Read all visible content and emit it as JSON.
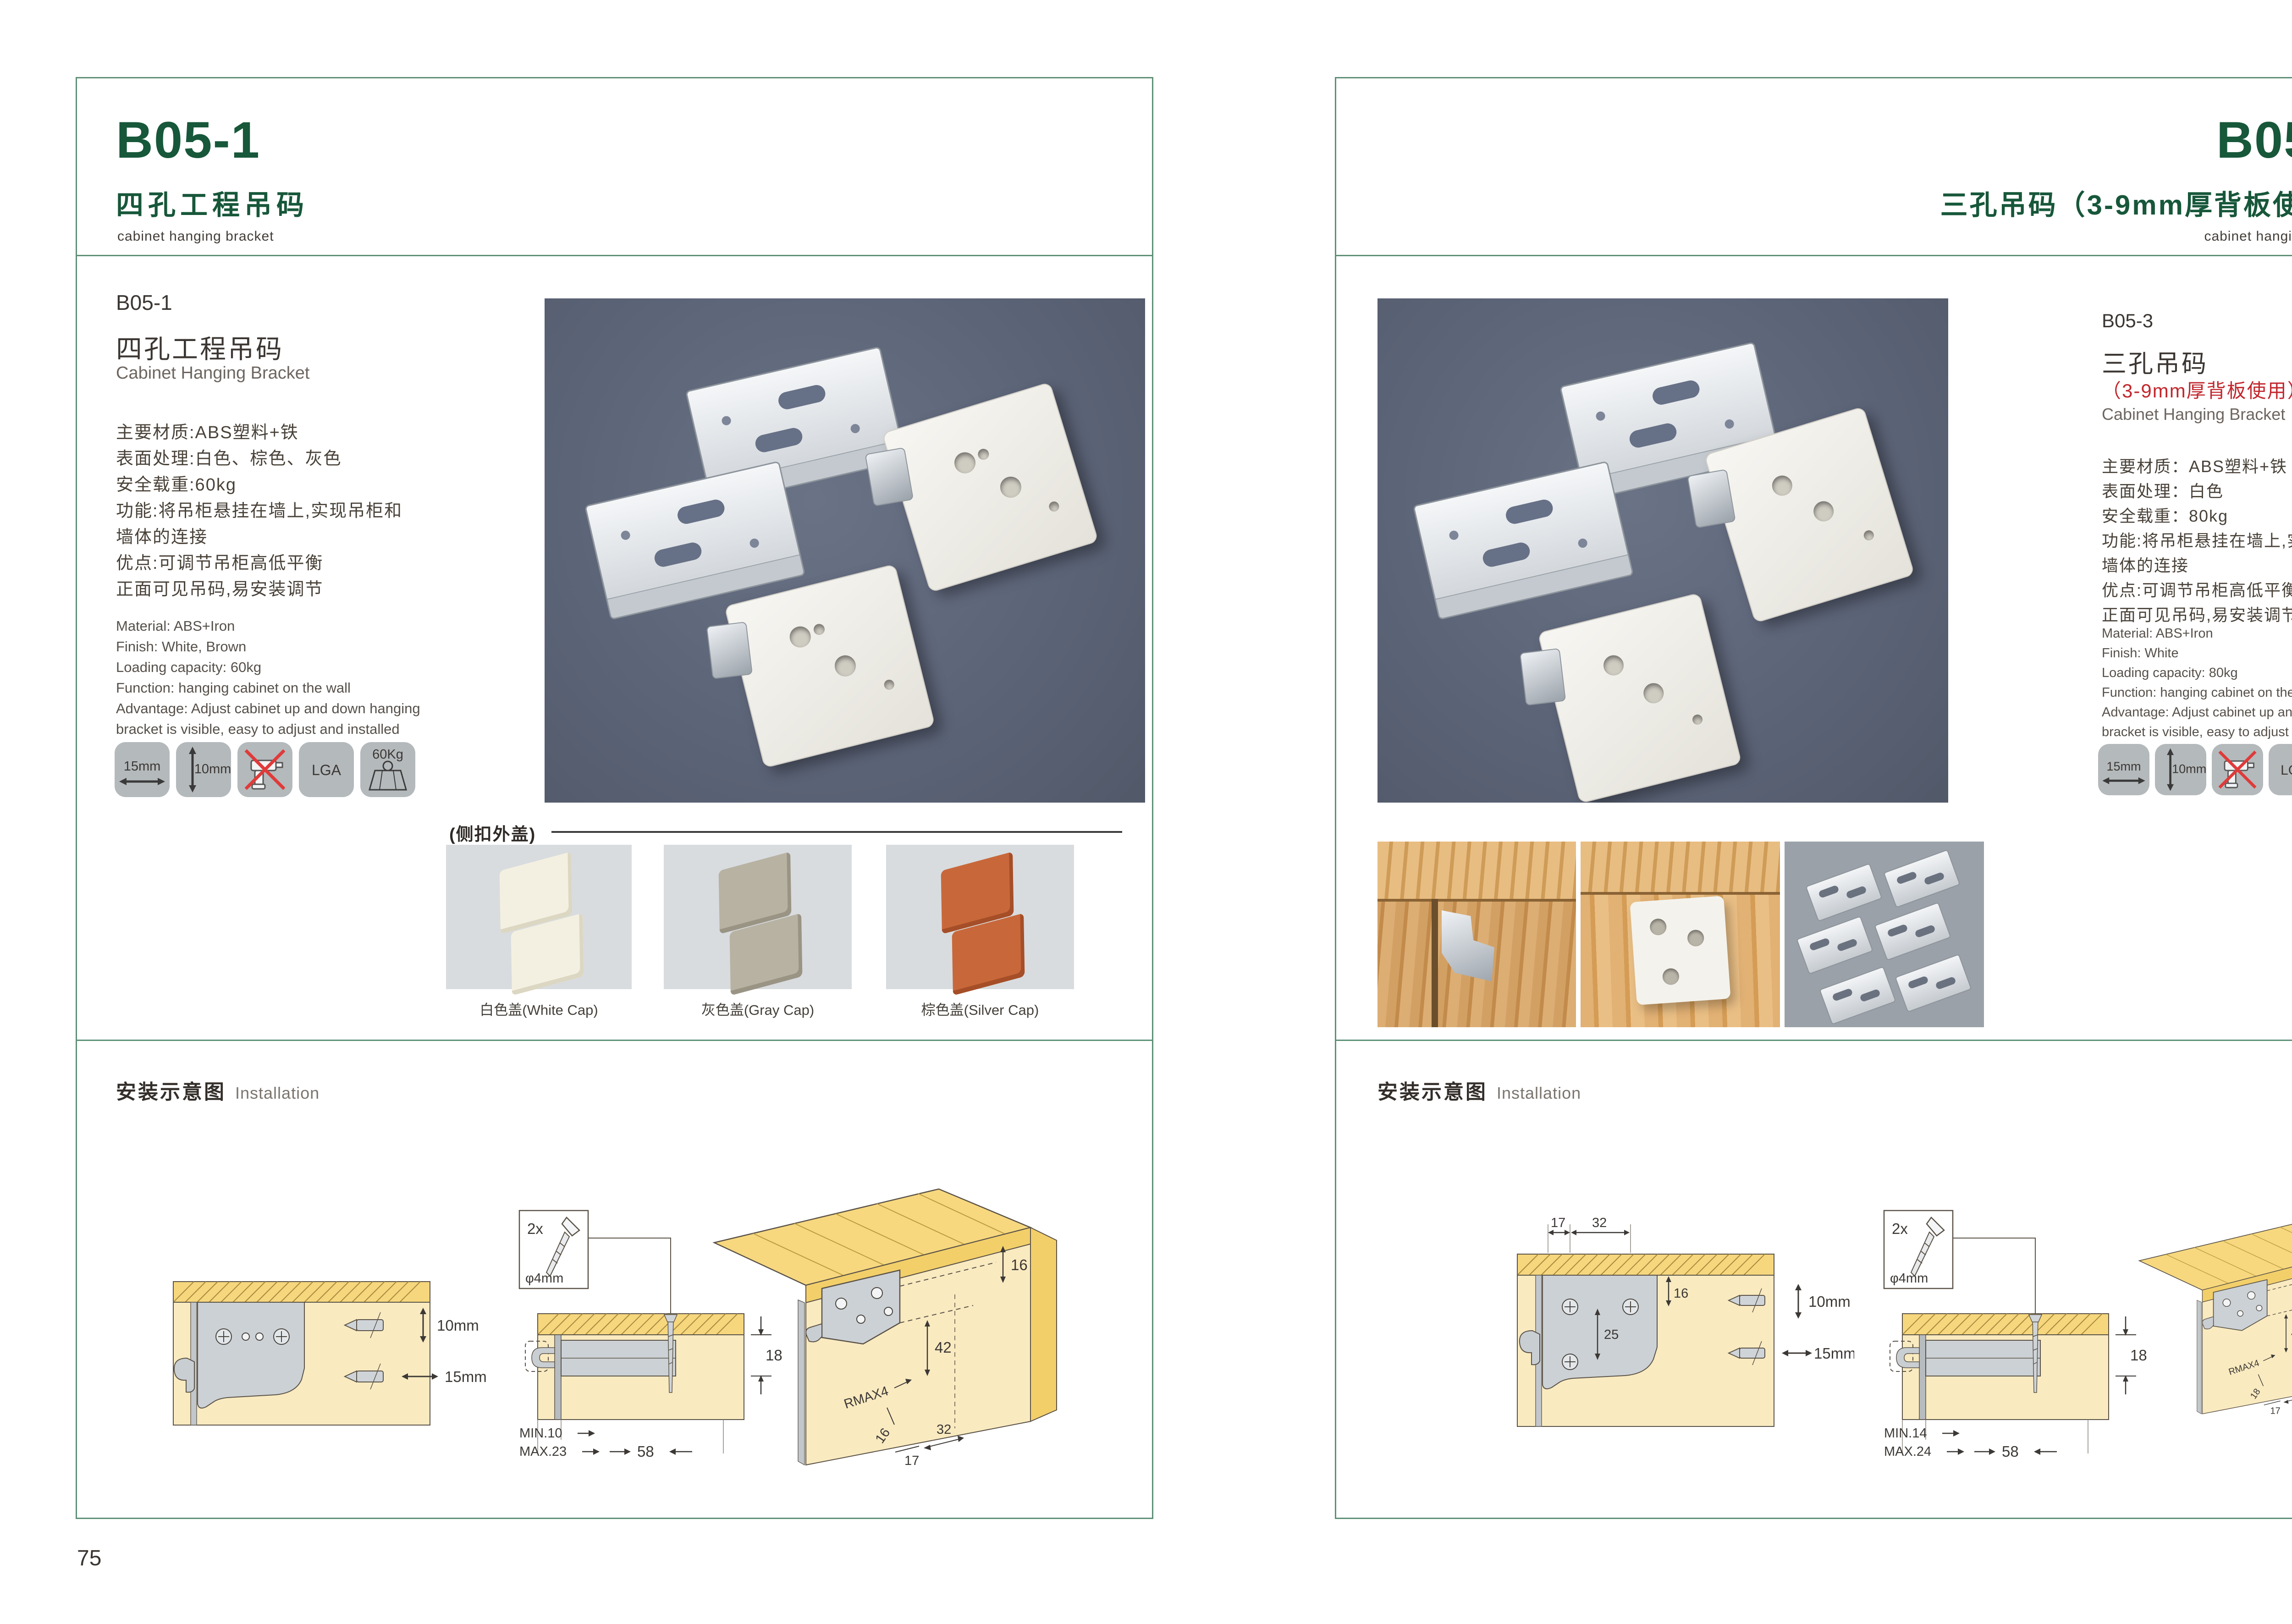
{
  "page": {
    "left_number": "75",
    "right_number": "76"
  },
  "colors": {
    "accent_green": "#17573a",
    "border_green": "#5f9078",
    "note_red": "#c1272d",
    "photo_bg": "#5c6478",
    "icon_tile_bg": "#b4b9bb"
  },
  "left": {
    "header": {
      "code": "B05-1",
      "title_cn": "四孔工程吊码",
      "subtitle_en": "cabinet hanging bracket"
    },
    "product": {
      "code": "B05-1",
      "name_cn": "四孔工程吊码",
      "name_en": "Cabinet Hanging Bracket",
      "specs_cn": [
        "主要材质:ABS塑料+铁",
        "表面处理:白色、棕色、灰色",
        "安全载重:60kg",
        "功能:将吊柜悬挂在墙上,实现吊柜和",
        "墙体的连接",
        "优点:可调节吊柜高低平衡",
        "正面可见吊码,易安装调节"
      ],
      "specs_en": [
        "Material: ABS+Iron",
        "Finish: White, Brown",
        "Loading capacity: 60kg",
        "Function: hanging cabinet on the wall",
        "Advantage: Adjust cabinet up and down hanging",
        "bracket is visible, easy to adjust and installed"
      ],
      "icons": [
        {
          "label": "15mm",
          "type": "width-arrow"
        },
        {
          "label": "10mm",
          "type": "height-arrow"
        },
        {
          "label": "",
          "type": "no-drill"
        },
        {
          "label": "LGA",
          "type": "lga"
        },
        {
          "label": "60Kg",
          "type": "weight"
        }
      ]
    },
    "caps": {
      "heading": "(侧扣外盖)",
      "items": [
        {
          "label": "白色盖(White Cap)"
        },
        {
          "label": "灰色盖(Gray Cap)"
        },
        {
          "label": "棕色盖(Silver Cap)"
        }
      ]
    },
    "installation": {
      "title_cn": "安装示意图",
      "title_en": "Installation",
      "diagram1": {
        "dim_top": "10mm",
        "dim_bottom": "15mm"
      },
      "diagram2": {
        "qty": "2x",
        "dia": "φ4mm",
        "dim_side": "18",
        "min": "MIN.10",
        "max": "MAX.23",
        "span": "58"
      },
      "diagram3": {
        "d_top": "16",
        "d_mid": "42",
        "d_r": "RMAX4",
        "d_b1": "16",
        "d_b2": "17",
        "d_b3": "32"
      }
    }
  },
  "right": {
    "header": {
      "code": "B05-3",
      "title_cn": "三孔吊码（3-9mm厚背板使用）",
      "subtitle_en": "cabinet hanging bracket"
    },
    "product": {
      "code": "B05-3",
      "name_cn": "三孔吊码",
      "name_cn_note": "（3-9mm厚背板使用）",
      "name_en": "Cabinet Hanging Bracket",
      "specs_cn": [
        "主要材质：ABS塑料+铁",
        "表面处理：白色",
        "安全载重：80kg",
        "功能:将吊柜悬挂在墙上,实现吊柜和",
        "墙体的连接",
        "优点:可调节吊柜高低平衡",
        "正面可见吊码,易安装调节"
      ],
      "specs_en": [
        "Material: ABS+Iron",
        "Finish: White",
        "Loading capacity: 80kg",
        "Function: hanging cabinet on the wall",
        "Advantage: Adjust cabinet up and down hanging",
        "bracket is visible, easy to adjust and installed"
      ],
      "icons": [
        {
          "label": "15mm",
          "type": "width-arrow"
        },
        {
          "label": "10mm",
          "type": "height-arrow"
        },
        {
          "label": "",
          "type": "no-drill"
        },
        {
          "label": "LGA",
          "type": "lga"
        },
        {
          "label": "80Kg",
          "type": "weight"
        }
      ]
    },
    "installation": {
      "title_cn": "安装示意图",
      "title_en": "Installation",
      "diagram1": {
        "t1": "17",
        "t2": "32",
        "h1": "16",
        "h2": "25",
        "s1": "10mm",
        "s2": "15mm"
      },
      "diagram2": {
        "qty": "2x",
        "dia": "φ4mm",
        "dim_side": "18",
        "min": "MIN.14",
        "max": "MAX.24",
        "span": "58"
      },
      "diagram3": {
        "d_top": "16",
        "d_mid": "42",
        "d_r": "RMAX4",
        "d_b1": "18",
        "d_b2": "17",
        "d_b3": "32"
      }
    }
  }
}
